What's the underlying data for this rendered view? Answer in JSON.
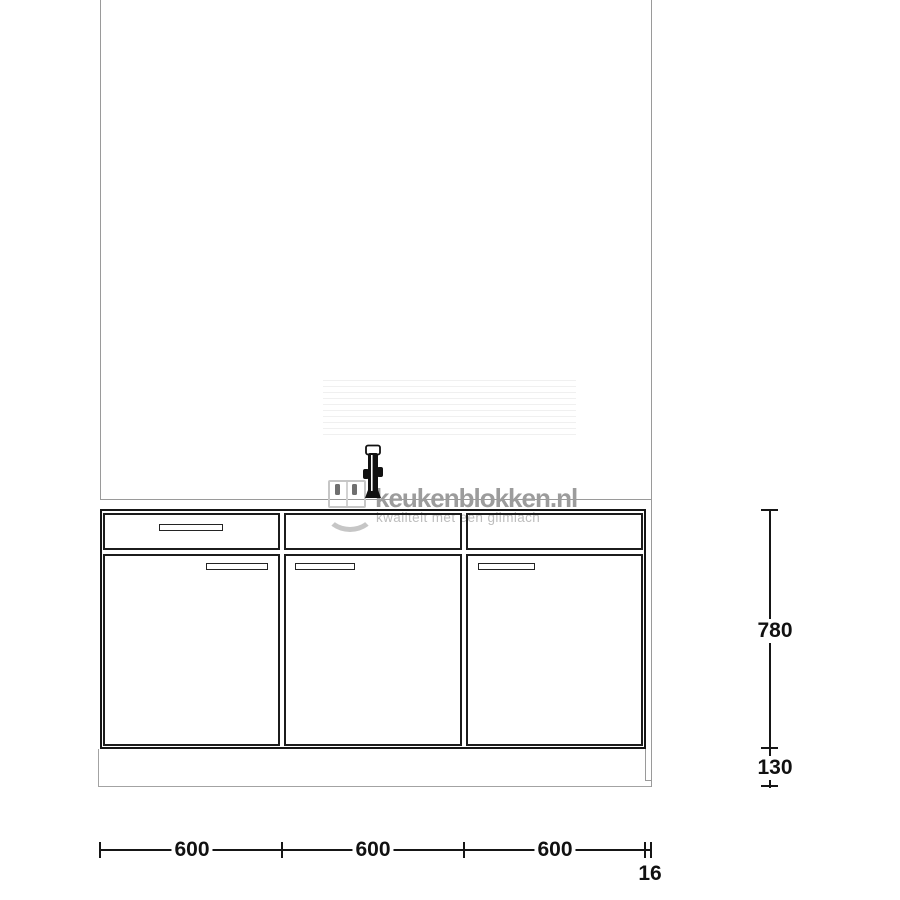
{
  "watermark": {
    "brand": "keukenblokken.nl",
    "tagline": "kwaliteit met een glimlach",
    "logo": "smiling-cabinet-face"
  },
  "dimensions": {
    "cabinet_height": "780",
    "plinth_height": "130",
    "section_widths": [
      "600",
      "600",
      "600"
    ],
    "side_panel_thickness": "16"
  },
  "drawing": {
    "sections": 3,
    "top_row_fronts": [
      "drawer-with-handle",
      "blank-front",
      "blank-front"
    ],
    "doors": [
      "handle-right",
      "handle-left",
      "handle-left"
    ],
    "fixtures": [
      "faucet"
    ]
  },
  "colors": {
    "line": "#161616",
    "thin_line": "#9a9a9a",
    "watermark_text": "#9c9c9c",
    "watermark_shape": "#c6c6c6"
  }
}
